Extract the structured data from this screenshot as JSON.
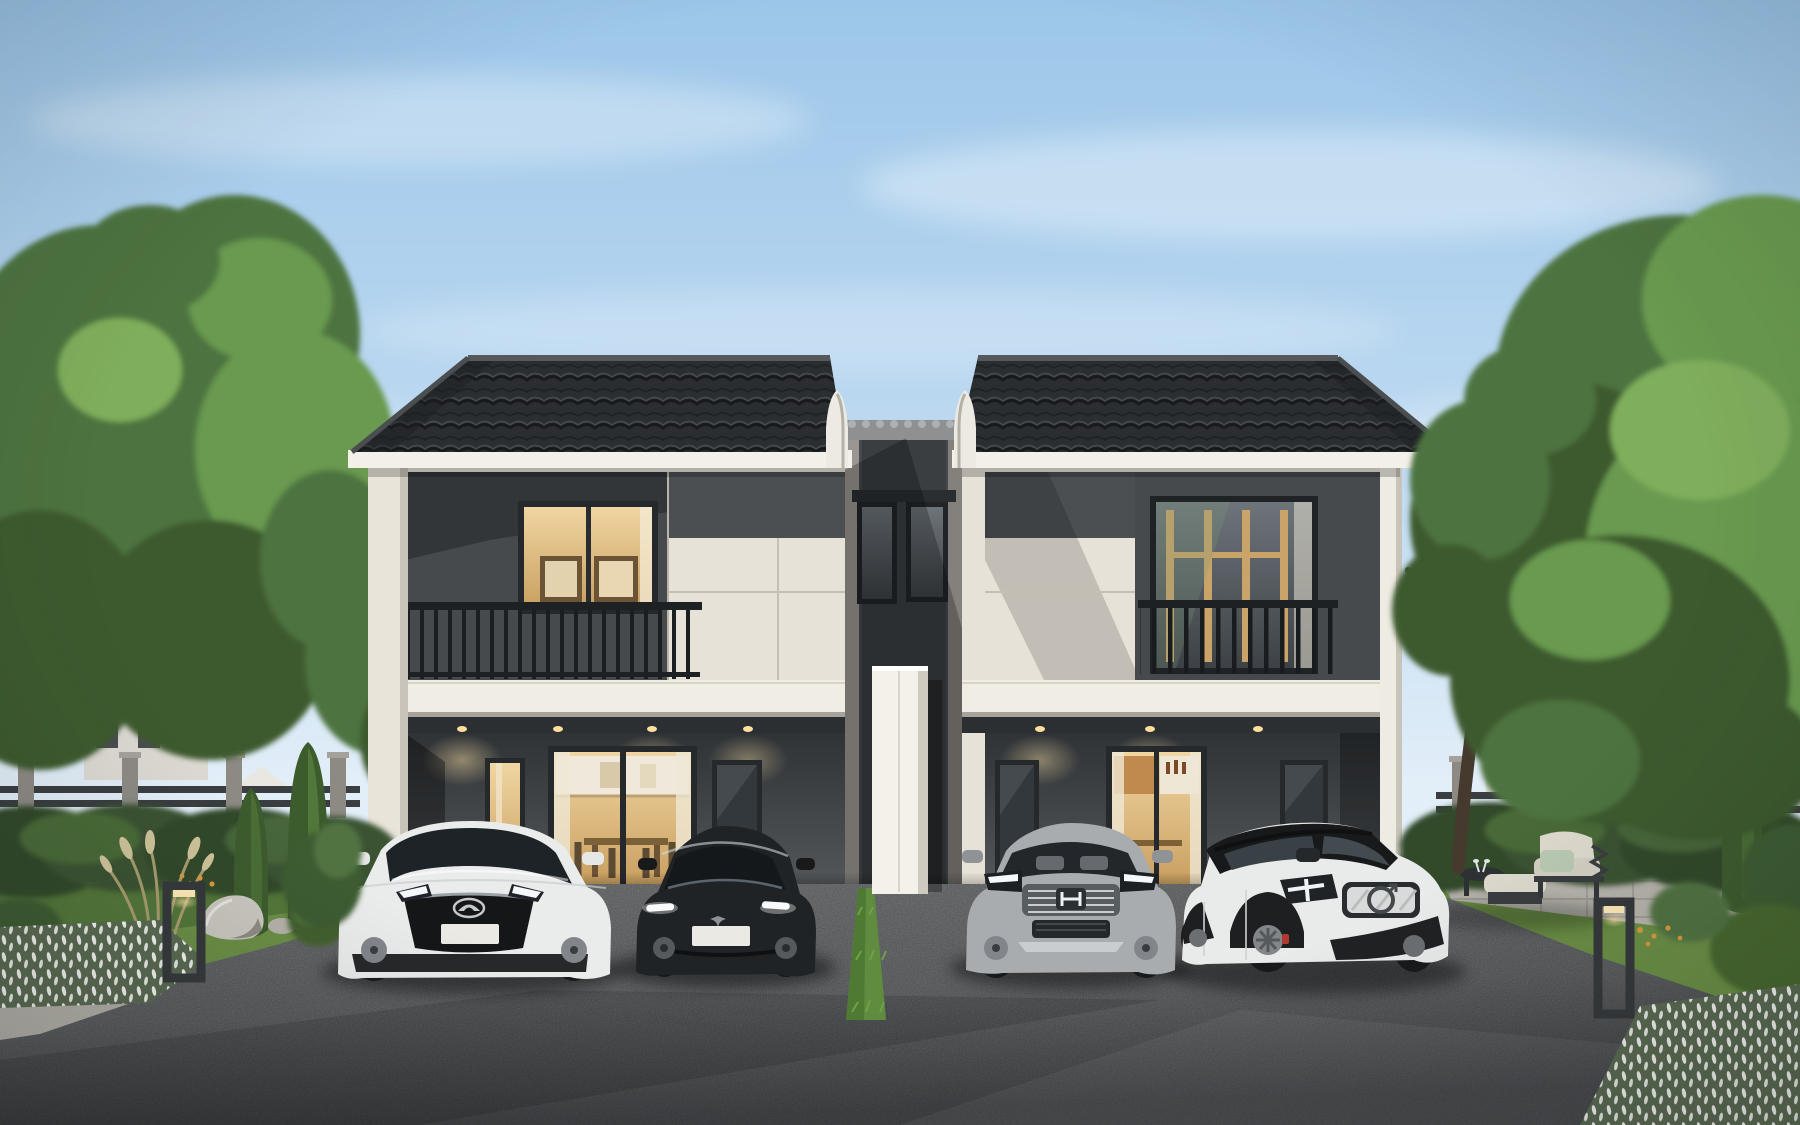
{
  "scene": {
    "description": "Photorealistic dusk rendering of a modern two-storey twin duplex house with black tiled roofs, cream and charcoal facade, lit interiors, four cars parked on the asphalt driveway, landscaped gardens with hedges, trees, outdoor lounge furniture and bollard lights",
    "sky": {
      "top": "#9cc6e9",
      "mid": "#c2dcf2",
      "horizon": "#e2eef8",
      "cloud": "#ffffff"
    },
    "building": {
      "roof": "#2b2e30",
      "roof_highlight": "#3e4245",
      "ridge": "#55595c",
      "fascia": "#f3f0e9",
      "gable_trim": "#eceae2",
      "wall_cream": "#e7e2d8",
      "wall_cream_shade": "#cfcabf",
      "wall_dark": "#464a4d",
      "wall_darker": "#33373a",
      "parapet": "#f0ede5",
      "fin_wall": "#f4f1ea",
      "window_warm": "#f0d6a2",
      "window_warm_deep": "#c99f60",
      "window_glass": "#59606568",
      "railing": "#1e2124",
      "wood_frame": "#c9a368",
      "soffit": "#2c2f32",
      "downlight": "#ffdf9e"
    },
    "ground": {
      "asphalt": "#8c8f91",
      "asphalt_dark": "#55585b",
      "lawn": "#6b8f46",
      "lawn_shade": "#53773a",
      "grass_strip": "#5f8c3e",
      "hedge": "#33482a",
      "hedge_light": "#4a6b38",
      "paver": "#b7b4ac",
      "stone": "#cac7c0",
      "curb": "#b2afa7"
    },
    "vegetation": {
      "tree_dark": "#3c5a2e",
      "tree_mid": "#4e7340",
      "tree_light": "#699a4f",
      "tree_bright": "#7fae5c",
      "conifer": "#3d5c2e",
      "flower_white": "#f2f3ee",
      "flower_orange": "#d99a3c",
      "plume": "#cfc49a"
    },
    "fence": {
      "rail": "#3a3e41",
      "post": "#8d8a84"
    },
    "background_house": {
      "wall": "#dcd9d2",
      "window": "#4a4e51"
    },
    "furniture": {
      "cushion": "#ddd9cd",
      "pillow": "#b9c9b2",
      "frame": "#3a3d3f",
      "table": "#2f3234"
    },
    "bollard": {
      "frame": "#36393b",
      "glow": "#ffe9b8"
    },
    "cars": [
      {
        "name": "white compact SUV",
        "brand_logo": "mazda",
        "body": "#eaeceb",
        "glass": "#1e2327",
        "trim": "#1a1c1e"
      },
      {
        "name": "black fastback sedan",
        "brand_logo": "tesla",
        "body": "#202325",
        "glass": "#15181b",
        "trim": "#0e1012"
      },
      {
        "name": "silver compact SUV",
        "brand_logo": "honda",
        "body": "#a8acae",
        "glass": "#23272a",
        "trim": "#2a2d2f"
      },
      {
        "name": "white SUV with black roof",
        "brand_logo": "volvo",
        "body": "#e9ebeb",
        "glass": "#1a1d1f",
        "trim": "#1f2123"
      }
    ],
    "car_parts": {
      "tire": "#17191b",
      "rim": "#82868a",
      "caliper": "#b03a2e",
      "plate": "#eae9e4",
      "headlight": "#f4f8fa",
      "chrome": "#c4c9cc"
    }
  }
}
